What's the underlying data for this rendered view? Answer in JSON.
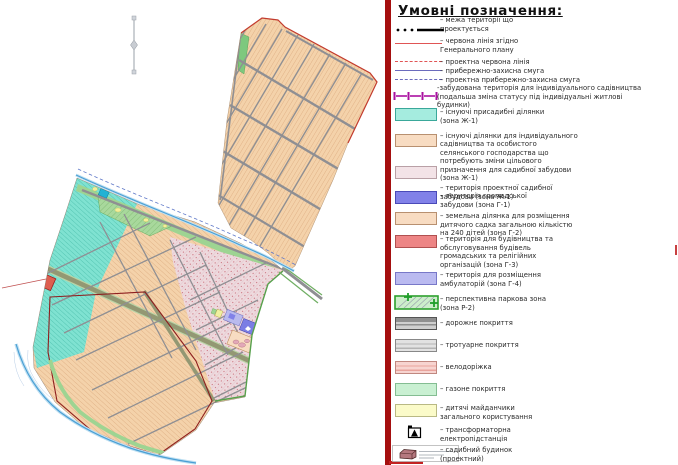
{
  "legend": {
    "title": "Умовні позначення:",
    "items": [
      {
        "id": "project-boundary",
        "symbol": "black-dots-thick-line",
        "color": "#000000",
        "label": "– межа території що\nпроектується"
      },
      {
        "id": "red-line-master-plan",
        "symbol": "red-solid-line",
        "color": "#e05555",
        "label": "– червона лінія згідно\nГенерального плану"
      },
      {
        "id": "project-red-line",
        "symbol": "red-dashed-line",
        "color": "#e05555",
        "label": "– проектна червона лінія"
      },
      {
        "id": "coastal-protection-strip",
        "symbol": "purple-solid-line",
        "color": "#6b6bbd",
        "label": "– прибережно-захисна смуга"
      },
      {
        "id": "project-coastal-protection-strip",
        "symbol": "purple-dashed-line",
        "color": "#6b6bbd",
        "label": "– проектна прибережно-захисна смуга"
      },
      {
        "id": "built-up-gardening-territory",
        "symbol": "magenta-post-line",
        "color": "#aa11a0",
        "label": "-забудована територія для індивідуального садівництва\n(подальша зміна статусу під індивідуальні житлові\nбудинки)"
      },
      {
        "id": "existing-homestead-plots",
        "symbol": "swatch",
        "color": "#a5ecdf",
        "label": "– існуючі присадибні ділянки\n(зона Ж-1)"
      },
      {
        "id": "existing-gardening-plots",
        "symbol": "swatch",
        "color": "#f8dcc2",
        "label": "– існуючі ділянки для індивідуального\nсадівництва та особистого\nселянського господарства що\nпотребують зміни цільового\nпризначення для садибної забудови\n(зона Ж-1)"
      },
      {
        "id": "project-homestead-territory",
        "symbol": "swatch",
        "color": "#f3e3e7",
        "label": "– територія проектної садибної\nзабудови (зона Ж-1)"
      },
      {
        "id": "public-building-territory",
        "symbol": "swatch",
        "color": "#8181e8",
        "label": "– територія громадської\nзабудови (зона Г-1)"
      },
      {
        "id": "kindergarten-plot",
        "symbol": "swatch",
        "color": "#f8dcc2",
        "label": "– земельна ділянка для розміщення\nдитячого садка загальною кількістю\nна 240 дітей (зона Г-2)"
      },
      {
        "id": "public-religious-buildings",
        "symbol": "swatch",
        "color": "#ed8585",
        "label": "– територія для будівництва та\nобслуговування будівель\nгромадських та релігійних\nорганізацій (зона Г-3)"
      },
      {
        "id": "ambulatory-territory",
        "symbol": "swatch",
        "color": "#babaf0",
        "label": "– територія для розміщення\nамбулаторій (зона Г-4)"
      },
      {
        "id": "perspective-park-zone",
        "symbol": "green-hatched-swatch",
        "color": "#cdeecb",
        "label": "– перспективна паркова зона\n(зона Р-2)"
      },
      {
        "id": "road-surface",
        "symbol": "gray-striped-swatch",
        "color": "#8f8f8f",
        "label": "– дорожнє покриття"
      },
      {
        "id": "sidewalk-surface",
        "symbol": "light-gray-striped-swatch",
        "color": "#e2e2e2",
        "label": "– тротуарне покриття"
      },
      {
        "id": "bike-path",
        "symbol": "pink-striped-swatch",
        "color": "#f7d4d0",
        "label": "– велодоріжка"
      },
      {
        "id": "lawn-surface",
        "symbol": "swatch",
        "color": "#c9f0d2",
        "label": "– газоне покриття"
      },
      {
        "id": "public-playgrounds",
        "symbol": "swatch",
        "color": "#fbfbc9",
        "label": "– дитячі майданчики\nзагального користування"
      },
      {
        "id": "transformer-substation",
        "symbol": "transformer-icon",
        "color": "#000000",
        "label": "– трансформаторна\nелектропідстанція"
      },
      {
        "id": "homestead-house-project",
        "symbol": "house-icon",
        "color": "#b5787f",
        "label": "– садибний будинок\n(проектний)"
      }
    ]
  },
  "map": {
    "features": [
      "north-arrow",
      "upper-allotment-area",
      "lower-settlement-area",
      "park-strip",
      "streams",
      "red-line-boundary",
      "kindergarten-block",
      "public-building-block",
      "ambulatory-block",
      "church-plot",
      "pond"
    ],
    "colors": {
      "parcel_peach": "#f4d2aa",
      "parcel_cyan": "#7fe2d1",
      "parcel_pink": "#eedade",
      "park_green": "#9ed492",
      "road_gray": "#8f8f93",
      "road_olive": "#939873",
      "stream_blue": "#4a9fd4",
      "red_line": "#c23b2e",
      "dark_red_outline": "#8e1f1f",
      "public_purple": "#7b7de4",
      "ambulatory_lavender": "#b9baee",
      "church_red": "#dd5f50",
      "playground_yellow": "#f0f0a0",
      "pond_cyan": "#22b2d4"
    }
  }
}
